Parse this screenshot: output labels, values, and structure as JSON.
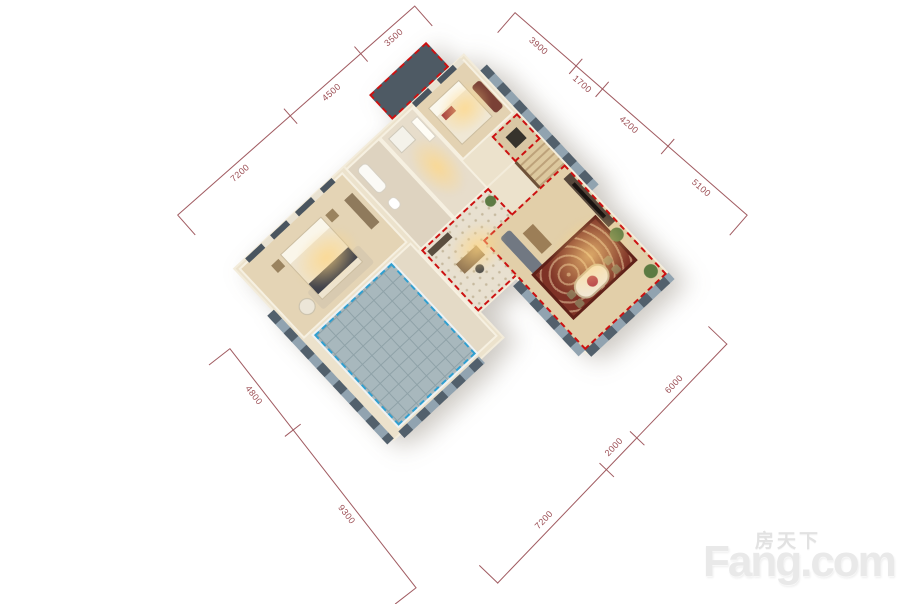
{
  "dims": {
    "top_left": [
      "7200",
      "4500",
      "3500"
    ],
    "top_right": [
      "3900",
      "1700",
      "4200",
      "5100"
    ],
    "bottom_left": [
      "4800",
      "9300"
    ],
    "bottom_right": [
      "7200",
      "2000",
      "6000"
    ]
  },
  "watermark": {
    "brand_cn": "房天下",
    "brand_en": "Fang.com"
  },
  "colors": {
    "dimension_line": "#9c4f55",
    "void_outline": "#cc1111",
    "terrace_outline": "#2f9fd0",
    "facade": "#52606c",
    "floor_warm": "#e4d4b5",
    "wall_top": "#f6f0e1",
    "rug": "#7e3226",
    "watermark": "#e9e9e9"
  }
}
